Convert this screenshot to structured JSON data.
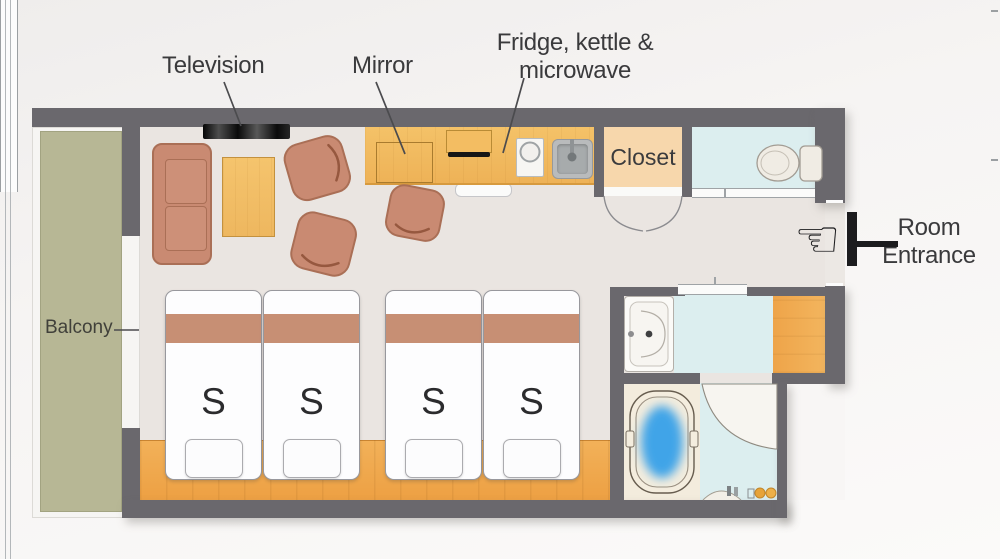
{
  "plan_type": "hotel-room-floor-plan",
  "annotations": {
    "television": "Television",
    "mirror": "Mirror",
    "fridge_line1": "Fridge, kettle &",
    "fridge_line2": "microwave",
    "balcony": "Balcony",
    "closet": "Closet",
    "entrance_line1": "Room",
    "entrance_line2": "Entrance"
  },
  "beds": {
    "items": [
      {
        "label": "S"
      },
      {
        "label": "S"
      },
      {
        "label": "S"
      },
      {
        "label": "S"
      }
    ]
  },
  "icons": {
    "entrance_hand": {
      "name": "left-pointing-hand-icon",
      "glyph": "☜"
    },
    "entrance_door": {
      "name": "door-symbol-icon"
    }
  },
  "colors": {
    "wall": "#6a686d",
    "room_floor": "#eae5e1",
    "wood": "#efa74c",
    "upholstery": "#c98a72",
    "bed_stripe": "#c78f74",
    "balcony_floor": "#b7b795",
    "wet_room_floor": "#dceeef",
    "closet_floor": "#f7d7ac",
    "bathroom_floor": "#f3ecdd",
    "bath_water": "#3fa4e8",
    "label_text": "#3a3a3c"
  }
}
